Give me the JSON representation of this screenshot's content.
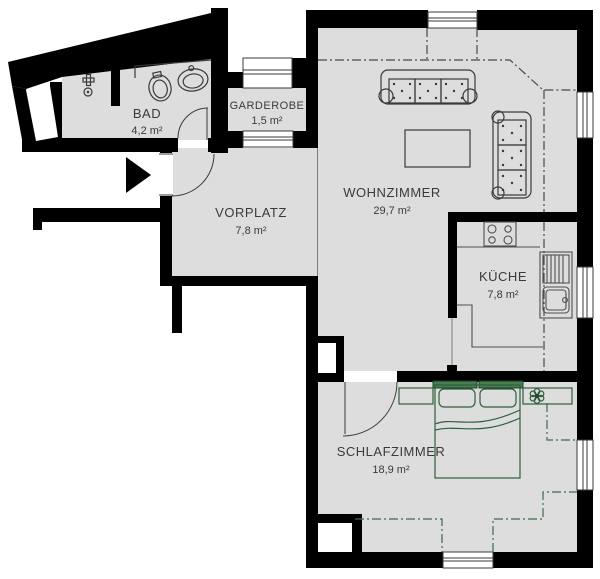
{
  "fp": {
    "rooms": [
      {
        "name": "BAD",
        "area": "4,2 m²",
        "color": "#dfe26a"
      },
      {
        "name": "GARDEROBE",
        "area": "1,5 m²",
        "color": "#9b99cd"
      },
      {
        "name": "VORPLATZ",
        "area": "7,8 m²",
        "color": "#fcb441"
      },
      {
        "name": "WOHNZIMMER",
        "area": "29,7 m²",
        "color": "#9b9c9e"
      },
      {
        "name": "KÜCHE",
        "area": "7,8 m²",
        "color": "#d9dbdc"
      },
      {
        "name": "SCHLAFZIMMER",
        "area": "18,9 m²",
        "color": "#a8d3a1"
      }
    ],
    "colors": {
      "wall": "#000000",
      "background": "#ffffff",
      "furniture_outline": "#3a3a3a",
      "kitchen_outline": "#4f4f4f",
      "bedroom_outline": "#2e5f3c",
      "headboard_fill": "#477d51",
      "pillow_fill": "#cfe8c8",
      "roof_slope_line": "#4a4a4a",
      "roof_slope_line_bedroom": "#3c6b49"
    },
    "symbols": [
      "entrance-arrow",
      "door-swing",
      "window",
      "toilet",
      "washbasin",
      "bathroom-counter",
      "stove",
      "kitchen-sink",
      "kitchen-counter",
      "sofa-3-seat",
      "sofa-3-seat-vertical",
      "coffee-table",
      "double-bed",
      "nightstand",
      "shelf",
      "plant",
      "roof-slope-line",
      "wall-niche",
      "shaft"
    ]
  }
}
